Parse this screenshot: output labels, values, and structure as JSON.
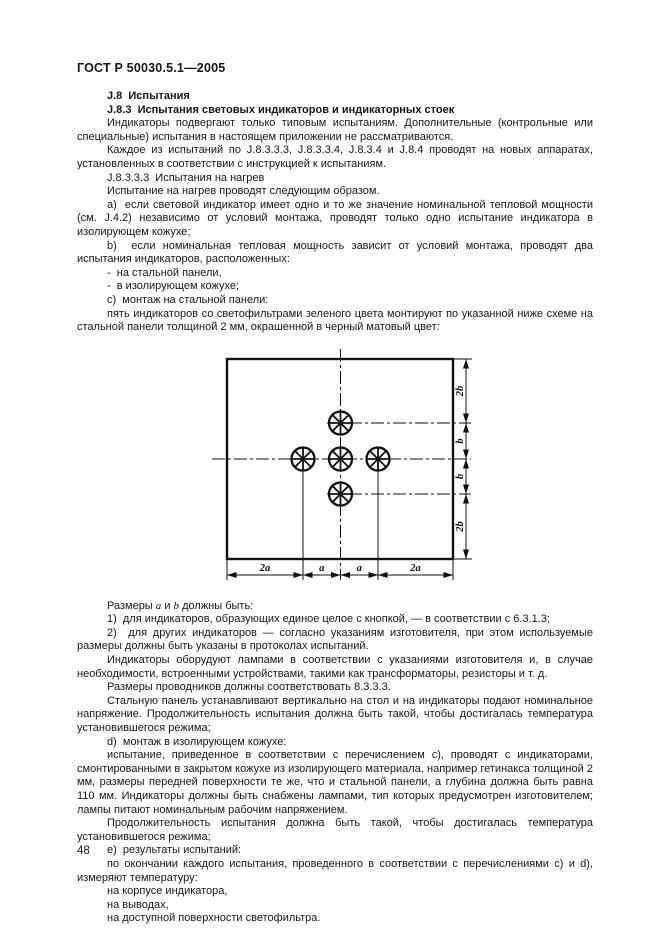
{
  "header": {
    "title": "ГОСТ Р 50030.5.1—2005"
  },
  "footer": {
    "page_number": "48"
  },
  "paragraphs_before": [
    {
      "k": "h",
      "t": "J.8  Испытания"
    },
    {
      "k": "h",
      "t": "J.8.3  Испытания световых индикаторов и индикаторных стоек"
    },
    {
      "k": "p",
      "t": "Индикаторы подвергают только типовым испытаниям. Дополнительные (контрольные или специальные) испытания в настоящем приложении не рассматриваются."
    },
    {
      "k": "p",
      "t": "Каждое из испытаний по J.8.3.3.3, J.8.3.3.4, J.8.3.4 и J.8.4 проводят на новых аппаратах, установленных в соответствии с инструкцией к испытаниям."
    },
    {
      "k": "p",
      "t": "J.8.3.3.3  Испытания на нагрев"
    },
    {
      "k": "p",
      "t": "Испытание на нагрев проводят следующим образом."
    },
    {
      "k": "p",
      "t": "a)  если световой индикатор имеет одно и то же значение номинальной тепловой мощности (см. J.4.2) независимо от условий монтажа, проводят только одно испытание индикатора в изолирующем кожухе;"
    },
    {
      "k": "p",
      "t": "b)  если номинальная тепловая мощность зависит от условий монтажа, проводят два испытания индикаторов, расположенных:"
    },
    {
      "k": "p",
      "t": "-  на стальной панели,"
    },
    {
      "k": "p",
      "t": "-  в изолирующем кожухе;"
    },
    {
      "k": "p",
      "t": "c)  монтаж на стальной панели:"
    },
    {
      "k": "p",
      "t": "пять индикаторов со светофильтрами зеленого цвета монтируют по указанной ниже схеме на стальной панели толщиной 2 мм, окрашенной в черный матовый цвет:"
    }
  ],
  "figure": {
    "name": "indicator-mounting-scheme",
    "bottom_labels": [
      "2a",
      "a",
      "a",
      "2a"
    ],
    "right_labels": [
      "2b",
      "b",
      "b",
      "2b"
    ]
  },
  "paragraphs_after": [
    {
      "k": "p",
      "parts": [
        {
          "t": "Размеры "
        },
        {
          "t": "a",
          "v": true
        },
        {
          "t": " и "
        },
        {
          "t": "b",
          "v": true
        },
        {
          "t": " должны быть:"
        }
      ]
    },
    {
      "k": "p",
      "t": "1)  для индикаторов, образующих единое целое с кнопкой, — в соответствии с 6.3.1.3;"
    },
    {
      "k": "p",
      "t": "2)  для других индикаторов — согласно указаниям изготовителя, при этом используемые размеры должны быть указаны в протоколах испытаний."
    },
    {
      "k": "p",
      "t": "Индикаторы оборудуют лампами в соответствии с указаниями изготовителя и, в случае необходимости, встроенными устройствами, такими как трансформаторы, резисторы и т. д."
    },
    {
      "k": "p",
      "t": "Размеры проводников должны соответствовать 8.3.3.3."
    },
    {
      "k": "p",
      "t": "Стальную панель устанавливают вертикально на стол и на индикаторы подают номинальное напряжение. Продолжительность испытания должна быть такой, чтобы достигалась температура установившегося режима;"
    },
    {
      "k": "p",
      "t": "d)  монтаж в изолирующем кожухе:"
    },
    {
      "k": "p",
      "t": "испытание, приведенное в соответствии с перечислением c), проводят с индикаторами, смонтированными в закрытом кожухе из изолирующего материала, например гетинакса толщиной 2 мм, размеры передней поверхности те же, что и стальной панели, а глубина должна быть равна 110 мм. Индикаторы должны быть снабжены лампами, тип которых предусмотрен изготовителем; лампы питают номинальным рабочим напряжением."
    },
    {
      "k": "p",
      "t": "Продолжительность испытания должна быть такой, чтобы достигалась температура установившегося режима;"
    },
    {
      "k": "p",
      "t": "e)  результаты испытаний:"
    },
    {
      "k": "p",
      "t": "по окончании каждого испытания, проведенного в соответствии с перечислениями c) и d), измеряют температуру:"
    },
    {
      "k": "p",
      "t": "на корпусе индикатора,"
    },
    {
      "k": "p",
      "t": "на выводах,"
    },
    {
      "k": "p",
      "t": "на доступной поверхности светофильтра."
    }
  ]
}
